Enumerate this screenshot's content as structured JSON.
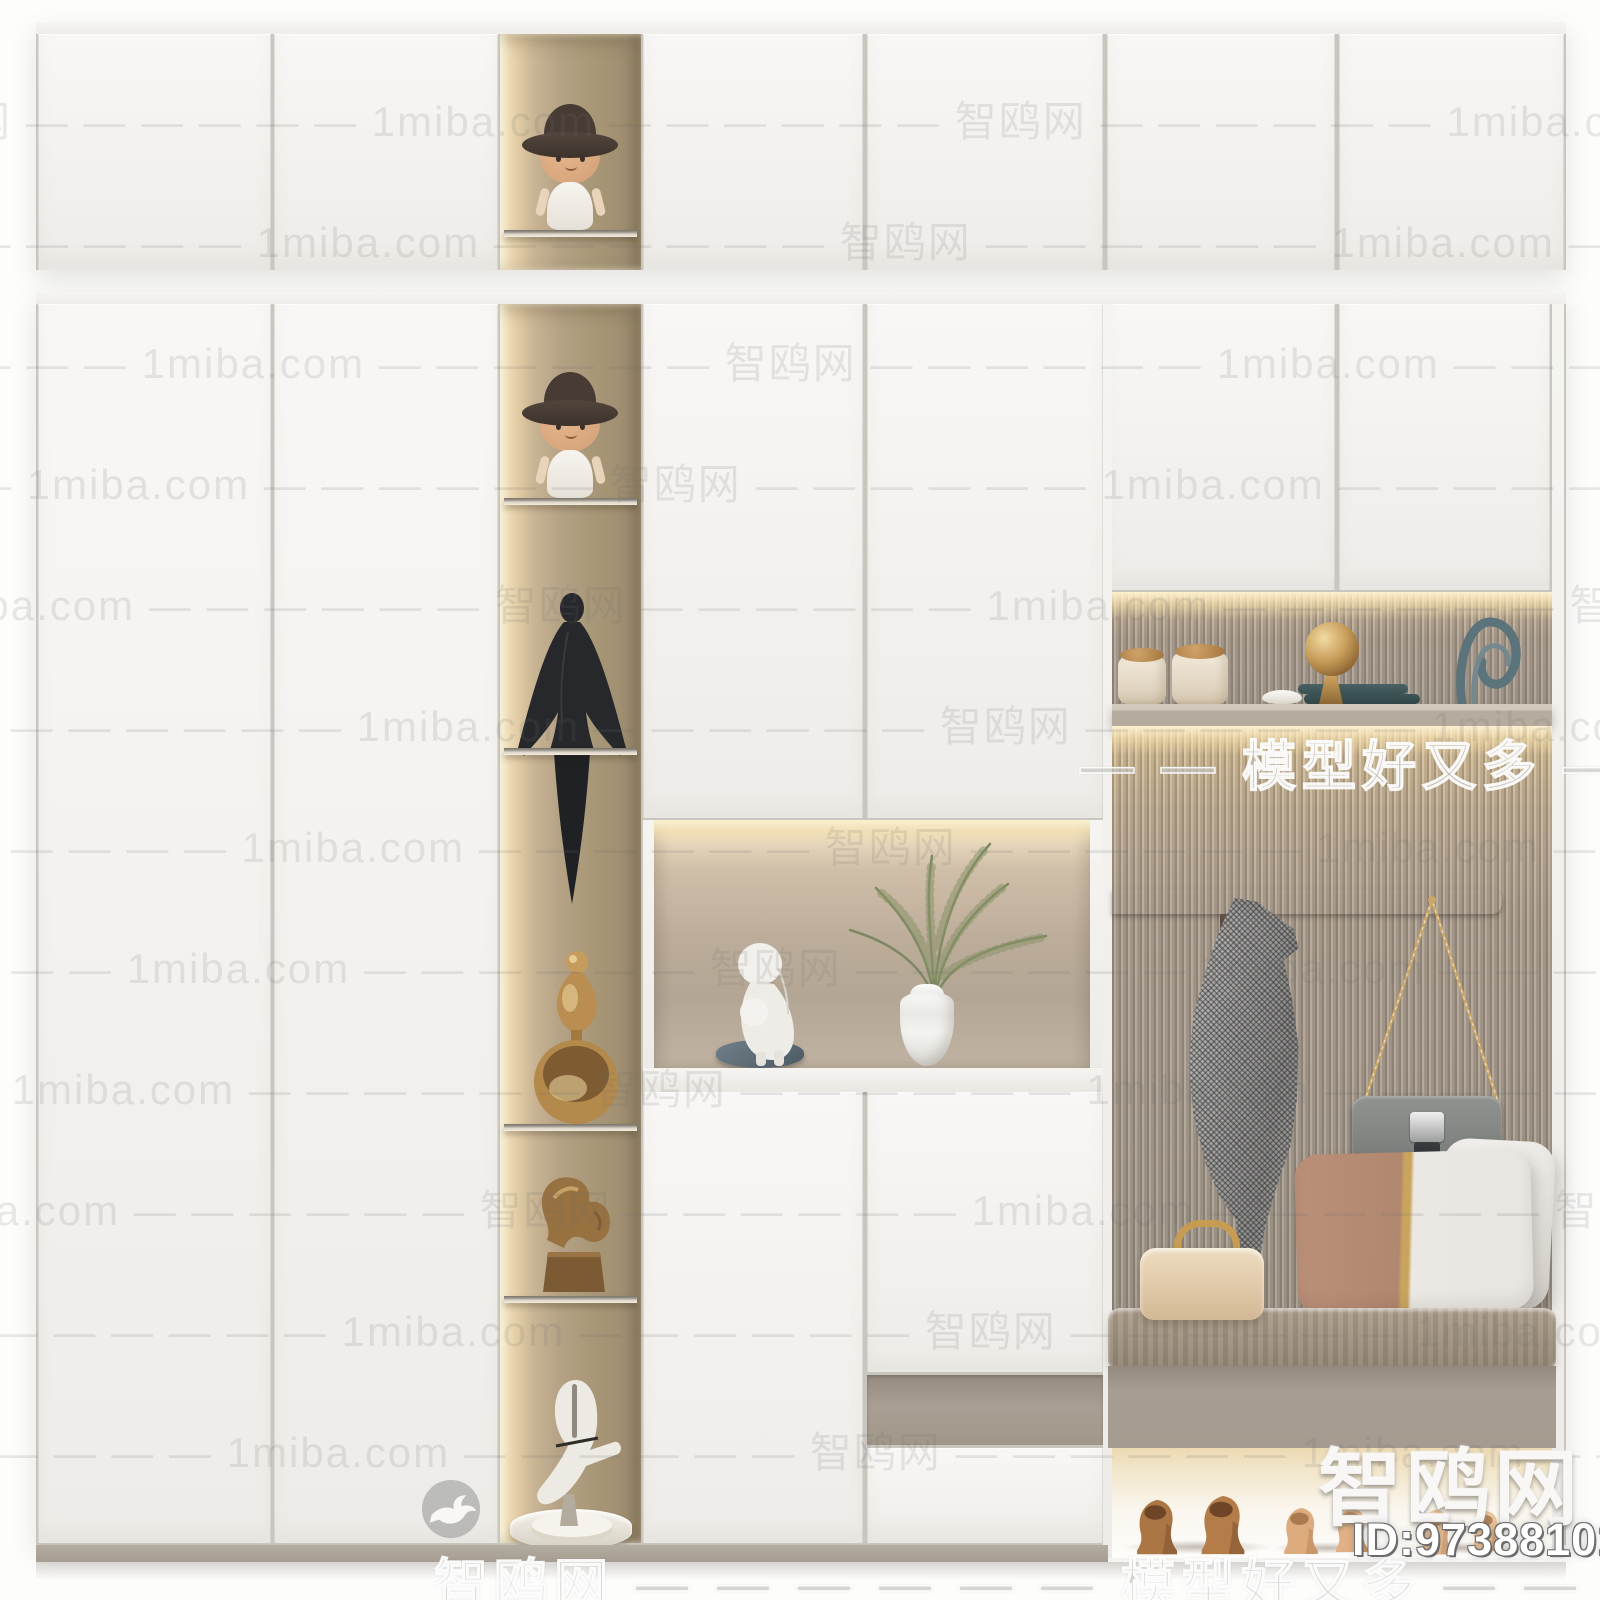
{
  "brand": {
    "site_cn": "智鸥网",
    "site_en": "1miba.com",
    "slogan": "模型好又多",
    "model_id": "ID:973881013"
  },
  "watermarks": {
    "tiled": {
      "text": "智鸥网 — — — — — —  1miba.com  — — — — — — 智鸥网 — — — — — —  1miba.com  — — — — — — 智鸥网 — — — — — —  1miba.com  — — — — — — 智鸥网 — — — — — —  1miba.com",
      "rows": 12,
      "top": 88,
      "step": 121,
      "shift": 115,
      "period": 560
    },
    "outline_right": "— — 模型好又多 — — —",
    "outline_bottom": "智鸥网 — — — — — — 模型好又多 — — — —",
    "logo_text": "智鸥网",
    "id_text": "ID:973881013"
  },
  "palette": {
    "door_white": "#f6f5f2",
    "niche_glow": "#f7e7c4",
    "niche_back": "#b3a287",
    "slat_wall": "#a89e92",
    "bench_taupe": "#a79d92",
    "accent_gold": "#c8a35c",
    "pillow_brown": "#b68c72",
    "scarf_gray": "#b0aeab",
    "bag_gray": "#878a87",
    "shoe_bronze": "#a9794c",
    "shoe_tan": "#ddab7d"
  }
}
